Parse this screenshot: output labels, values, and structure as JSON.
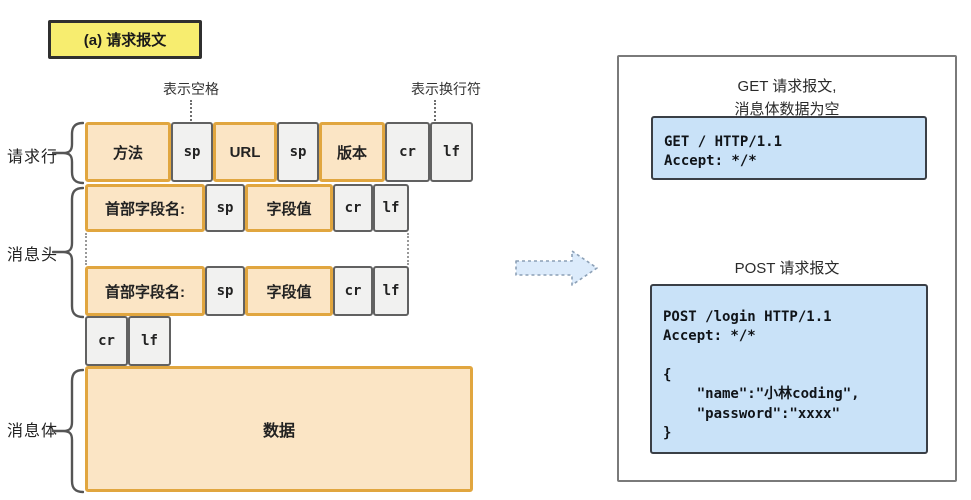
{
  "badge": {
    "label": "(a) 请求报文"
  },
  "annotations": {
    "space": "表示空格",
    "newline": "表示换行符"
  },
  "sections": {
    "request_line": "请求行",
    "message_header": "消息头",
    "message_body": "消息体"
  },
  "diagram": {
    "request_line": [
      "方法",
      "sp",
      "URL",
      "sp",
      "版本",
      "cr",
      "lf"
    ],
    "header_rows": [
      [
        "首部字段名:",
        "sp",
        "字段值",
        "cr",
        "lf"
      ],
      [
        "首部字段名:",
        "sp",
        "字段值",
        "cr",
        "lf"
      ]
    ],
    "crlf_row": [
      "cr",
      "lf"
    ],
    "body": "数据"
  },
  "right_panel": {
    "get_title": "GET 请求报文,\n消息体数据为空",
    "get_code": "GET / HTTP/1.1\nAccept: */*",
    "post_title": "POST 请求报文",
    "post_code": "POST /login HTTP/1.1\nAccept: */*\n\n{\n    \"name\":\"小林coding\",\n    \"password\":\"xxxx\"\n}"
  },
  "colors": {
    "badge_fill": "#F7ED6F",
    "field_fill": "#FBE5C5",
    "field_border": "#E1A63F",
    "ctrl_fill": "#F1F1F0",
    "ctrl_border": "#616161",
    "code_fill": "#C9E2F8",
    "code_border": "#3A3F46",
    "arrow_fill": "#DCEBFB"
  }
}
